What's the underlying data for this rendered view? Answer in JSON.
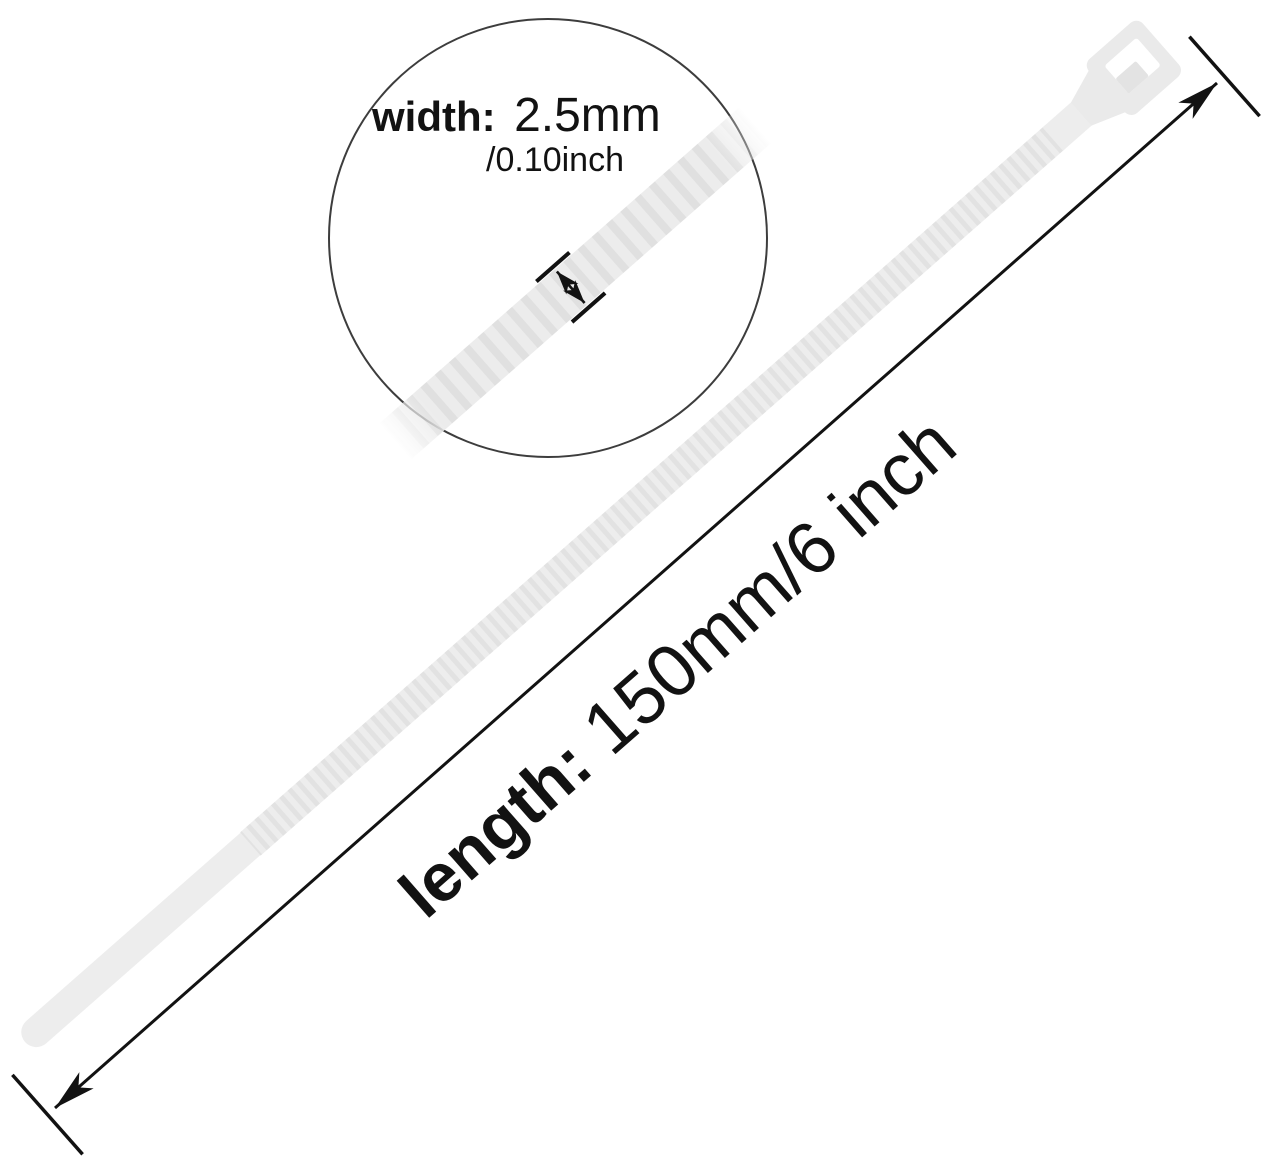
{
  "title": "Cable tie size diagram",
  "product": {
    "name": "nylon cable tie",
    "body_color": "#ededed",
    "ridge_color": "#e2e2e2",
    "head_color": "#eaeaea",
    "pawl_color": "#e3e3e3",
    "slot_color": "#ffffff"
  },
  "magnifier": {
    "band_color": "#ececec",
    "band_ridge_color": "#e0e0e0",
    "stroke_color": "#3d3d3d"
  },
  "dimension_width": {
    "label": "width:",
    "value_mm": "2.5mm",
    "value_inch": "/0.10inch"
  },
  "dimension_length": {
    "label": "length:",
    "value": "150mm/6 inch"
  },
  "line_color": "#121212",
  "background_color": "#ffffff"
}
